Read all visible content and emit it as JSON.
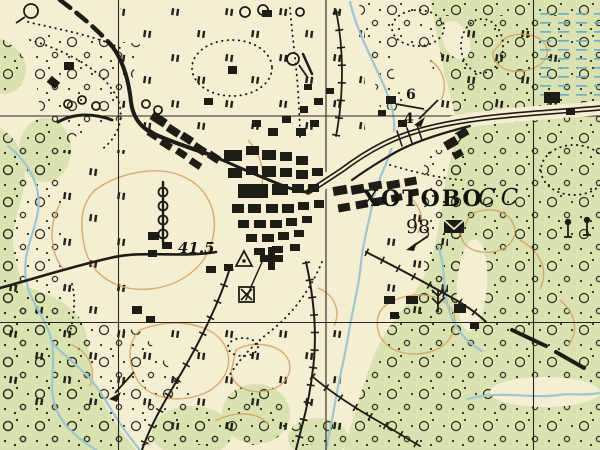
{
  "map": {
    "labels": {
      "settlement_name": "ХОТОВО",
      "settlement_type_abbr": "СС",
      "populated_point_number": "98",
      "spot_elevation": "41.5",
      "road_fraction_numerator": "6",
      "road_fraction_denominator": "4"
    },
    "colors": {
      "paper": "#f4eed2",
      "vegetation": "#d9e2b0",
      "water": "#9fc6cf",
      "contour": "#d8a365",
      "ink": "#1e1d15"
    },
    "symbols": {
      "geodetic_point": "triangle-with-center-dot",
      "church": "bold-cross",
      "post_office": "black-envelope",
      "mill": "square-with-diagonal-cross",
      "spring": "circle-with-tail",
      "lone_trees": "circle-on-trunk",
      "marsh_reeds": "barbed-stalk",
      "buildings": "solid-black-rectangles",
      "scrub": "dotted-circle-texture",
      "meadow": "double-tick-marks",
      "marsh": "horizontal-blue-dashes",
      "fenced_road": "line-with-crossbars",
      "improved_road": "double-cased-line"
    }
  }
}
